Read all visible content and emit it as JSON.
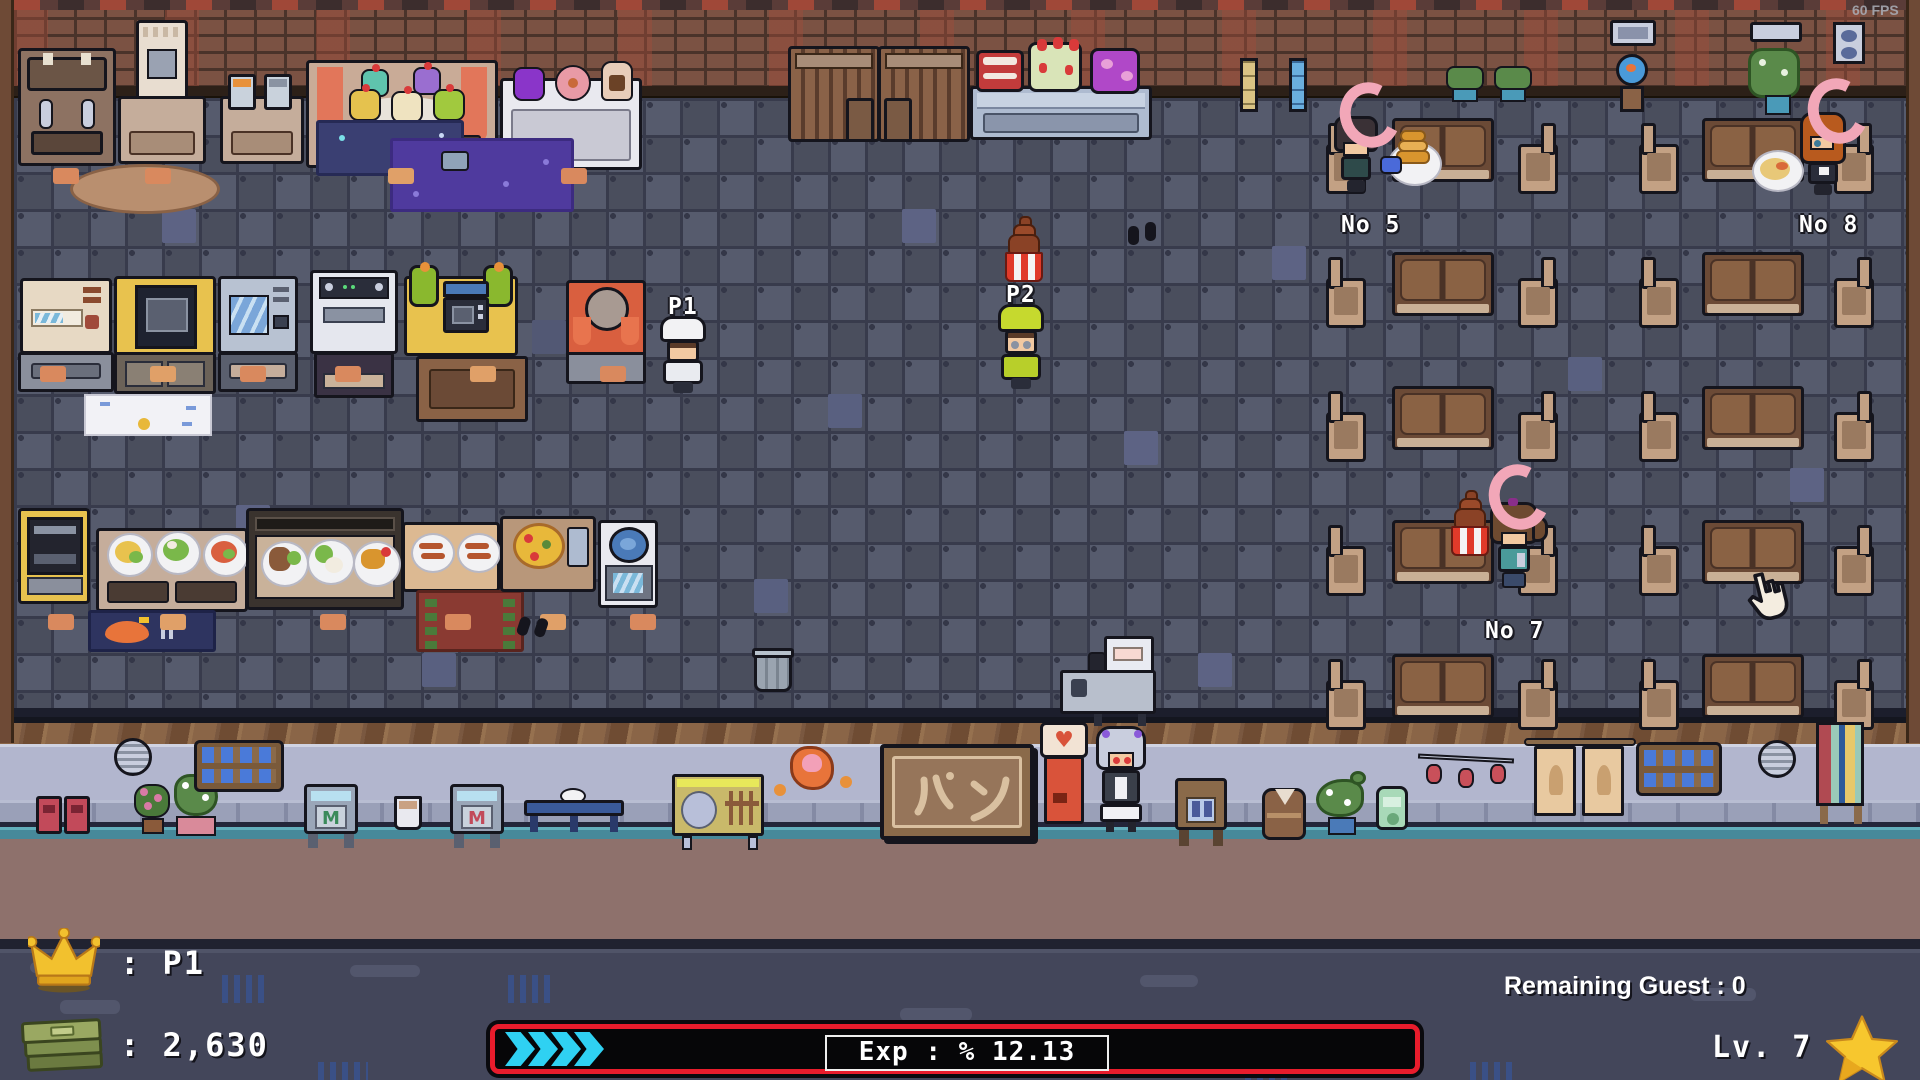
{
  "window": {
    "fps_label": "60 FPS"
  },
  "hud": {
    "leader": {
      "icon": "crown-icon",
      "label": ": P1"
    },
    "money": {
      "icon": "money-icon",
      "label": ": 2,630"
    },
    "exp": {
      "label": "Exp : % 12.13",
      "fill_percent": 12.13,
      "chevron_count": 4,
      "bar_border_color": "#e81c2c",
      "chevron_color": "#2fd1f2"
    },
    "remaining_guest_label": "Remaining Guest : 0",
    "level": {
      "label": "Lv. 7",
      "icon": "star-icon"
    }
  },
  "characters": {
    "p1": {
      "label": "P1"
    },
    "p2": {
      "label": "P2"
    },
    "guest_5": {
      "label": "No 5"
    },
    "guest_7": {
      "label": "No 7"
    },
    "guest_8": {
      "label": "No 8"
    }
  },
  "street": {
    "bakery_sign_text": "パン",
    "magazine_stand_letter": "M"
  },
  "colors": {
    "brick": "#7b5243",
    "floor_dark": "#4a4e5d",
    "floor_light": "#565b6d",
    "floor_accent": "#5d6384",
    "street_wall": "#b2b6ce",
    "road": "#8e716c",
    "lower_road": "#43465a",
    "exp_border": "#e81c2c",
    "exp_chevron": "#2fd1f2",
    "crescent": "#f2a7b8",
    "gold": "#f2c12e"
  }
}
